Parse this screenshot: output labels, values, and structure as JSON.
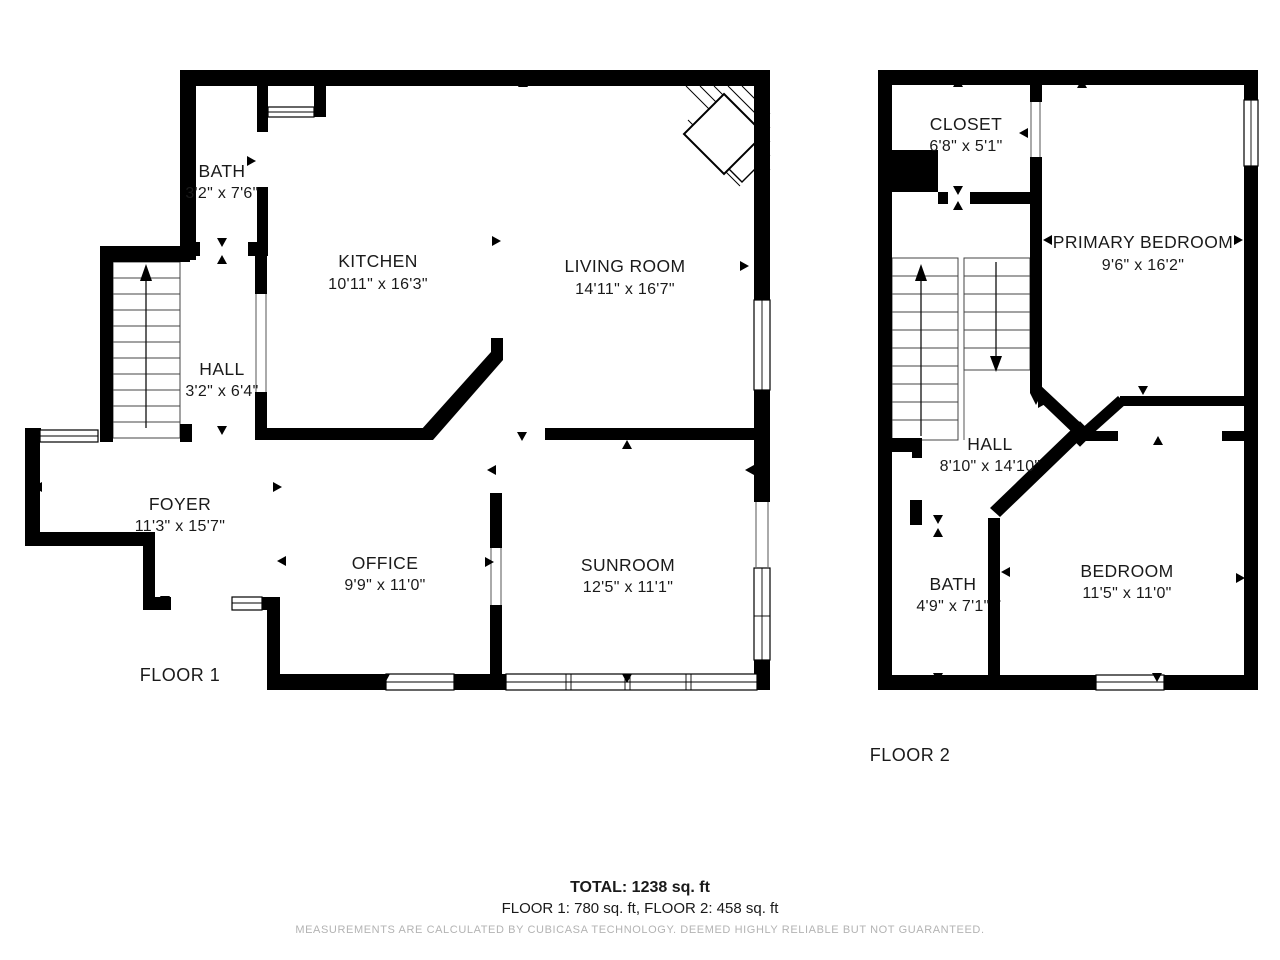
{
  "floor1": {
    "label": "FLOOR 1",
    "rooms": [
      {
        "name": "BATH",
        "dims": "3'2\" x 7'6\""
      },
      {
        "name": "KITCHEN",
        "dims": "10'11\" x 16'3\""
      },
      {
        "name": "LIVING ROOM",
        "dims": "14'11\" x 16'7\""
      },
      {
        "name": "HALL",
        "dims": "3'2\" x 6'4\""
      },
      {
        "name": "FOYER",
        "dims": "11'3\" x 15'7\""
      },
      {
        "name": "OFFICE",
        "dims": "9'9\" x 11'0\""
      },
      {
        "name": "SUNROOM",
        "dims": "12'5\" x 11'1\""
      }
    ]
  },
  "floor2": {
    "label": "FLOOR 2",
    "rooms": [
      {
        "name": "CLOSET",
        "dims": "6'8\" x 5'1\""
      },
      {
        "name": "PRIMARY BEDROOM",
        "dims": "9'6\" x 16'2\""
      },
      {
        "name": "HALL",
        "dims": "8'10\" x 14'10\""
      },
      {
        "name": "BATH",
        "dims": "4'9\" x 7'1\""
      },
      {
        "name": "BEDROOM",
        "dims": "11'5\" x 11'0\""
      }
    ]
  },
  "summary": {
    "total": "TOTAL: 1238 sq. ft",
    "floors": "FLOOR 1: 780 sq. ft, FLOOR 2: 458 sq. ft",
    "disclaimer": "MEASUREMENTS ARE CALCULATED BY CUBICASA TECHNOLOGY. DEEMED HIGHLY RELIABLE BUT NOT GUARANTEED."
  },
  "colors": {
    "wall": "#000000",
    "text": "#1a1a1a",
    "disclaimer": "#b3b3b3",
    "background": "#ffffff"
  }
}
